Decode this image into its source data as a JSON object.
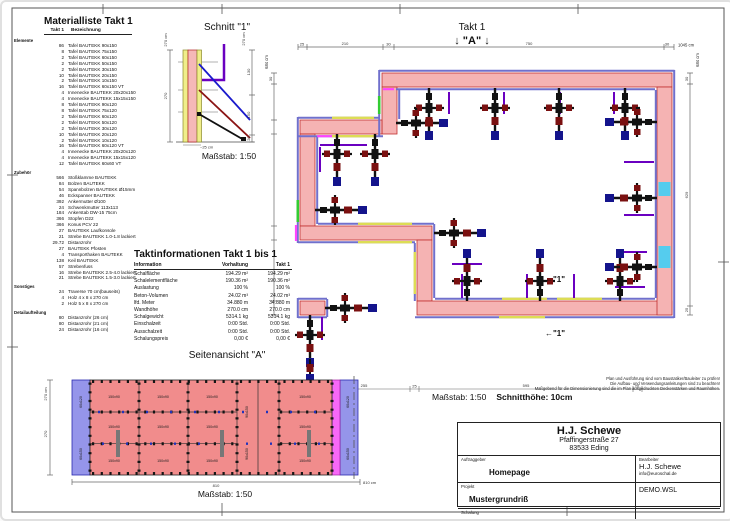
{
  "materialliste": {
    "title": "Materialliste  Takt 1",
    "header_qty": "Takt 1",
    "header_name": "Bezeichnung",
    "sections": [
      {
        "label": "Elemente",
        "items": [
          {
            "qty": "86",
            "name": "Tafel BAUTEKK  90x150"
          },
          {
            "qty": "8",
            "name": "Tafel BAUTEKK  75x150"
          },
          {
            "qty": "2",
            "name": "Tafel BAUTEKK  60x150"
          },
          {
            "qty": "2",
            "name": "Tafel BAUTEKK  50x150"
          },
          {
            "qty": "2",
            "name": "Tafel BAUTEKK  30x150"
          },
          {
            "qty": "10",
            "name": "Tafel BAUTEKK  20x150"
          },
          {
            "qty": "2",
            "name": "Tafel BAUTEKK  10x150"
          },
          {
            "qty": "16",
            "name": "Tafel BAUTEKK  60x150 VT"
          },
          {
            "qty": "4",
            "name": "Innenecke BAUTEKK  20x20x150"
          },
          {
            "qty": "4",
            "name": "Innenecke BAUTEKK  15x15x150"
          },
          {
            "qty": "8",
            "name": "Tafel BAUTEKK  90x120"
          },
          {
            "qty": "8",
            "name": "Tafel BAUTEKK  75x120"
          },
          {
            "qty": "2",
            "name": "Tafel BAUTEKK  60x120"
          },
          {
            "qty": "2",
            "name": "Tafel BAUTEKK  50x120"
          },
          {
            "qty": "2",
            "name": "Tafel BAUTEKK  30x120"
          },
          {
            "qty": "10",
            "name": "Tafel BAUTEKK  20x120"
          },
          {
            "qty": "2",
            "name": "Tafel BAUTEKK  10x120"
          },
          {
            "qty": "16",
            "name": "Tafel BAUTEKK  60x120 VT"
          },
          {
            "qty": "4",
            "name": "Innenecke BAUTEKK  20x20x120"
          },
          {
            "qty": "4",
            "name": "Innenecke BAUTEKK  15x15x120"
          },
          {
            "qty": "12",
            "name": "Tafel BAUTEKK  60x60 VT"
          }
        ]
      },
      {
        "label": "Zubehör",
        "items": [
          {
            "qty": "566",
            "name": "Stoßklamme BAUTEKK"
          },
          {
            "qty": "84",
            "name": "Bolzen BAUTEKK"
          },
          {
            "qty": "54",
            "name": "Spannbolzen BAUTEKK Ø15mm"
          },
          {
            "qty": "46",
            "name": "Eckspanner BAUTEKK"
          },
          {
            "qty": "392",
            "name": "Ankermutter Ø100"
          },
          {
            "qty": "24",
            "name": "Schwenkmutter 113x113"
          },
          {
            "qty": "184",
            "name": "Ankerstab DW-15 75cm"
          },
          {
            "qty": "366",
            "name": "Stopfen D22"
          },
          {
            "qty": "366",
            "name": "Konus PCV 22"
          },
          {
            "qty": "27",
            "name": "BAUTEKK Laufkonsole"
          },
          {
            "qty": "21",
            "name": "Strebe BAUTEKK 1.0-1.8 lackiert"
          },
          {
            "qty": "29.72",
            "name": "Distanzrohr"
          },
          {
            "qty": "27",
            "name": "BAUTEKK Pfosten"
          },
          {
            "qty": "4",
            "name": "Transporthaken BAUTEKK"
          },
          {
            "qty": "138",
            "name": "Keil BAUTEKK"
          },
          {
            "qty": "57",
            "name": "Strebenfuss"
          },
          {
            "qty": "16",
            "name": "Strebe BAUTEKK 2.5-4.0 lackiert"
          },
          {
            "qty": "21",
            "name": "Strebe BAUTEKK 1.5-3.0 lackiert"
          }
        ]
      },
      {
        "label": "Sonstiges",
        "items": [
          {
            "qty": "24",
            "name": "Traverse 70 cm(bauseits)"
          },
          {
            "qty": "4",
            "name": "Holz 4 x 8 x 270 cm"
          },
          {
            "qty": "2",
            "name": "Holz 5 x 8 x 270 cm"
          }
        ]
      },
      {
        "label": "Detailaufteilung",
        "items": [
          {
            "qty": "80",
            "name": "Distanzrohr (26 cm)"
          },
          {
            "qty": "80",
            "name": "Distanzrohr (21 cm)"
          },
          {
            "qty": "24",
            "name": "Distanzrohr (16 cm)"
          }
        ]
      }
    ]
  },
  "schnitt": {
    "title": "Schnitt \"1\"",
    "scale": "Maßstab: 1:50",
    "dim_height_label": "270 cm",
    "dim_height": "270",
    "chain": [
      "130",
      "150",
      "20"
    ],
    "approx_width": "~25 cm"
  },
  "plan": {
    "title": "Takt 1",
    "marker_a": "↓ \"A\" ↓",
    "marker_1": "←\"1\"",
    "scale_label": "Maßstab: 1:50",
    "section_height_label": "Schnitthöhe: 10cm",
    "dims_top": [
      "25",
      "210",
      "30",
      "750",
      "30"
    ],
    "dim_top_total": "1045 cm",
    "dims_right": [
      "30",
      "629",
      "25"
    ],
    "dim_right_total": "684 cm",
    "dim_left_total": "684 cm",
    "dim_left_first": "30",
    "dims_bottom": [
      "15",
      "255",
      "25",
      "595",
      "20"
    ]
  },
  "taktinfo": {
    "title": "Taktinformationen  Takt 1 bis 1",
    "col_headers": [
      "Information",
      "Vorhaltung",
      "Takt 1"
    ],
    "rows": [
      [
        "Schalfläche",
        "194.29 m²",
        "194.29 m²"
      ],
      [
        "Schalelementfläche",
        "190.36 m²",
        "190.36 m²"
      ],
      [
        "Auslastung",
        "100 %",
        "100 %"
      ],
      [
        "Beton-Volumen",
        "24.02 m³",
        "24.02 m³"
      ],
      [
        "lfd. Meter",
        "34.880 m",
        "34.880 m"
      ],
      [
        "Wandhöhe",
        "270.0 cm",
        "270.0 cm"
      ],
      [
        "Schalgewicht",
        "5314.1 kg",
        "5314.1 kg"
      ],
      [
        "Einschalzeit",
        "0:00 Std.",
        "0:00 Std."
      ],
      [
        "Ausschalzeit",
        "0:00 Std.",
        "0:00 Std."
      ],
      [
        "Schalungspreis",
        "0,00 €",
        "0,00 €"
      ]
    ]
  },
  "seitenansicht": {
    "title": "Seitenansicht \"A\"",
    "scale": "Maßstab: 1:50",
    "dim_height_label": "270 cm",
    "dim_height": "270",
    "dim_width": "810",
    "dim_width_label": "810 cm",
    "panel_red": "150x90",
    "panel_rot": "90x150",
    "panel_blue_top": "60x120",
    "panel_blue_bottom": "60x150"
  },
  "disclaimer_lines": [
    "Plan und Ausführung sind vom Baustatiker/Bauleiter zu prüfen!",
    "Die Aufbau- und Verwendungsanleitungen sind zu beachten!",
    "Maßgebend für die Dimensionierung sind die im Plan ausgedruckten Deckenstärken und Raumhöhen."
  ],
  "titleblock": {
    "company": "H.J. Schewe",
    "address1": "Pfaffingerstraße 27",
    "address2": "83533 Eding",
    "client_label": "Auftraggeber",
    "client": "Homepage",
    "editor_label": "Bearbeiter",
    "editor": "H.J. Schewe",
    "editor_email": "info@euroschal.de",
    "project_label": "Projekt",
    "project": "Mustergrundriß",
    "file": "DEMO.WSL",
    "formwork_label": "Schalung",
    "formwork": "Baukrane BAUTEKK (Hauptlager)",
    "date_label": "Datum",
    "date": "20.11.2023"
  }
}
